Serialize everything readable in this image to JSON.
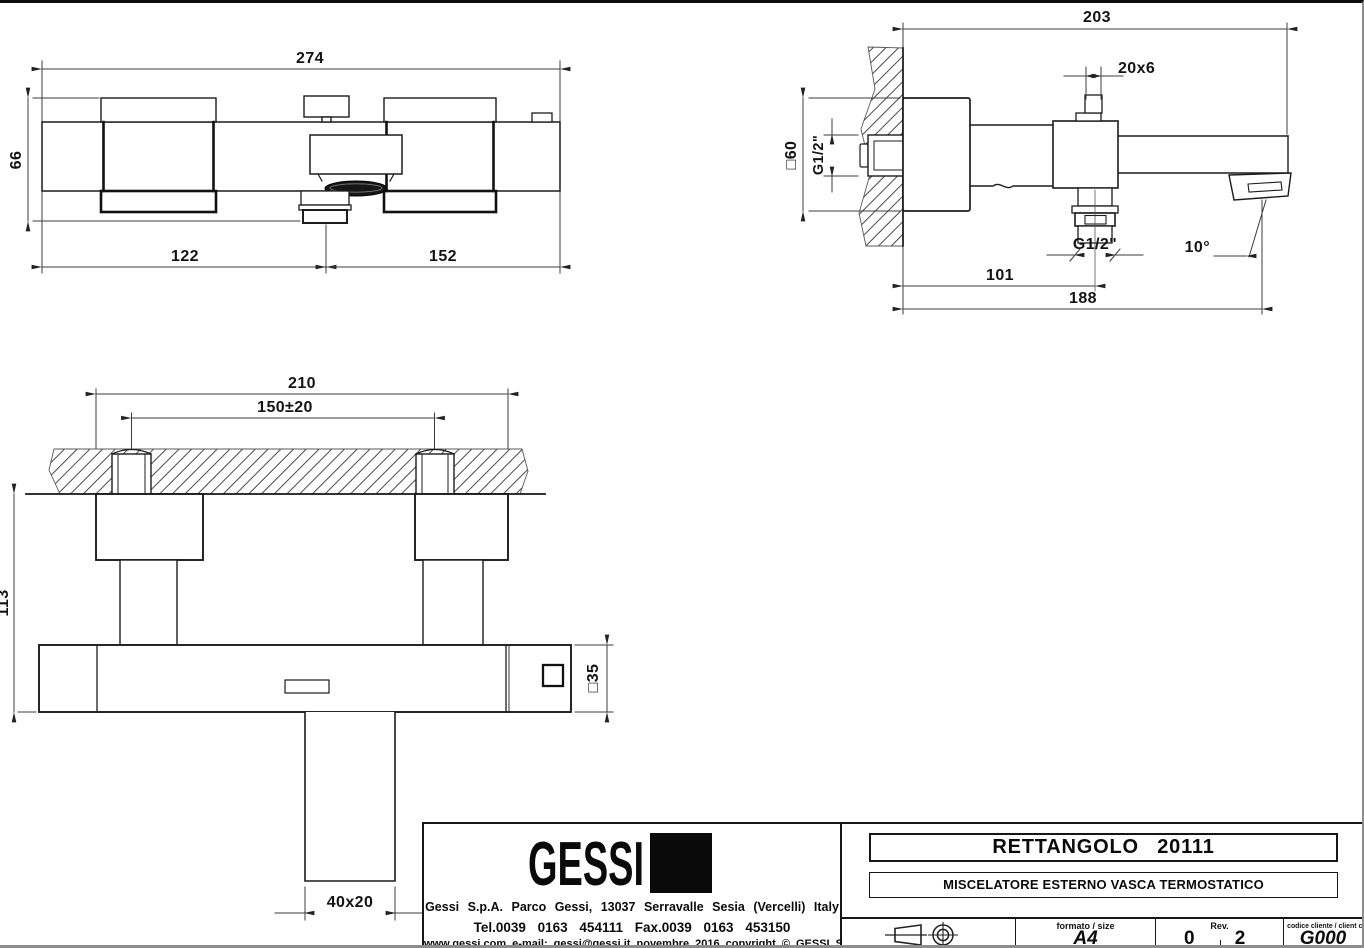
{
  "drawing": {
    "front_view": {
      "width_total": "274",
      "height_body": "66",
      "spout_offset_left": "122",
      "spout_offset_right": "152"
    },
    "side_view": {
      "depth_total": "203",
      "knob_section": "20x6",
      "escutcheon_section": "□60",
      "inlet_thread": "G1/2\"",
      "outlet_thread": "G1/2\"",
      "spout_angle": "10°",
      "outlet_offset": "101",
      "spout_reach": "188"
    },
    "plan_view": {
      "escutcheon_span": "210",
      "inlet_centers": "150±20",
      "drop_height": "113",
      "body_section": "□35",
      "spout_section": "40x20"
    }
  },
  "title_block": {
    "logo_text": "GESSI",
    "company_address": "Gessi S.p.A. Parco Gessi, 13037 Serravalle Sesia (Vercelli) Italy",
    "company_phone": "Tel.0039 0163 454111 Fax.0039 0163 453150",
    "company_web": "www.gessi.com e-mail: gessi@gessi.it novembre 2016 copyright © GESSI S.p.A.",
    "product_title": "RETTANGOLO 20111",
    "product_subtitle": "MISCELATORE ESTERNO VASCA TERMOSTATICO",
    "format_label": "formato / size",
    "format_value": "A4",
    "rev_label": "Rev.",
    "rev_value_left": "0",
    "rev_value_right": "2",
    "client_code_label": "codice cliente / client code",
    "client_code_value": "G000"
  }
}
